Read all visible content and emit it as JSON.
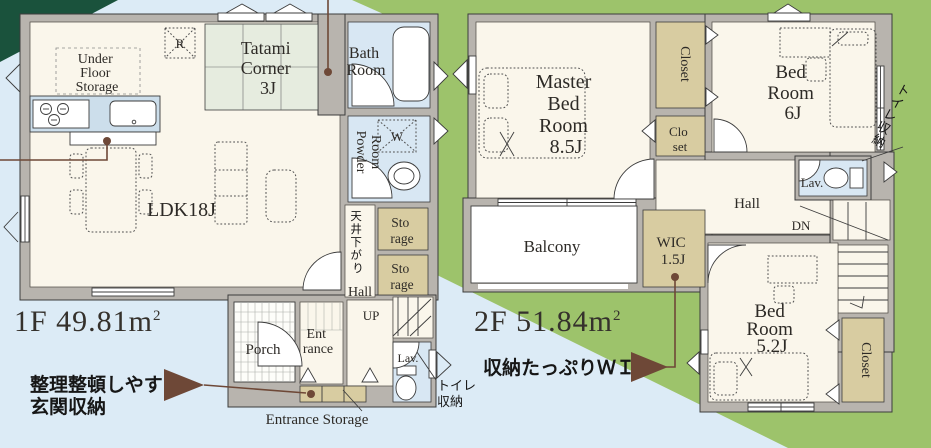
{
  "colors": {
    "bg_blue": "#dcebf6",
    "band_green": "#9dc36b",
    "corner_green": "#1a523c",
    "wall": "#b8b4ae",
    "floor": "#faf6eb",
    "tatami": "#e6ecdf",
    "wet": "#d8e7f3",
    "tan": "#d8cca1",
    "brown": "#6e4837",
    "ink": "#2d2a26"
  },
  "f1": {
    "area": "1F 49.81m",
    "area_sup": "2",
    "ldk": "LDK18J",
    "tatami": [
      "Tatami",
      "Corner",
      "3J"
    ],
    "under_floor": [
      "Under",
      "Floor",
      "Storage"
    ],
    "fridge": "R",
    "bath": [
      "Bath",
      "Room"
    ],
    "powder": [
      "Powder",
      "Room"
    ],
    "washer": "W",
    "ceiling": [
      "天",
      "井",
      "下",
      "が",
      "り"
    ],
    "storage1": [
      "Sto",
      "rage"
    ],
    "storage2": [
      "Sto",
      "rage"
    ],
    "hall": "Hall",
    "up": "UP",
    "entrance": [
      "Ent",
      "rance"
    ],
    "porch": "Porch",
    "lav": "Lav.",
    "toilet_storage": [
      "トイレ",
      "収納"
    ],
    "entrance_storage": "Entrance Storage",
    "callout": [
      "整理整頓しやすい",
      "玄関収納"
    ]
  },
  "f2": {
    "area": "2F 51.84m",
    "area_sup": "2",
    "master": [
      "Master",
      "Bed",
      "Room",
      "8.5J"
    ],
    "closet_a": "Closet",
    "closet_b": [
      "Clo",
      "set"
    ],
    "bed6": [
      "Bed",
      "Room",
      "6J"
    ],
    "toilet_storage": [
      "ト",
      "イ",
      "レ",
      "収",
      "納"
    ],
    "lav": "Lav.",
    "hall": "Hall",
    "dn": "DN",
    "balcony": "Balcony",
    "wic": [
      "WIC",
      "1.5J"
    ],
    "bed52": [
      "Bed",
      "Room",
      "5.2J"
    ],
    "closet_c": "Closet",
    "callout": "収納たっぷりＷＩＣ"
  }
}
